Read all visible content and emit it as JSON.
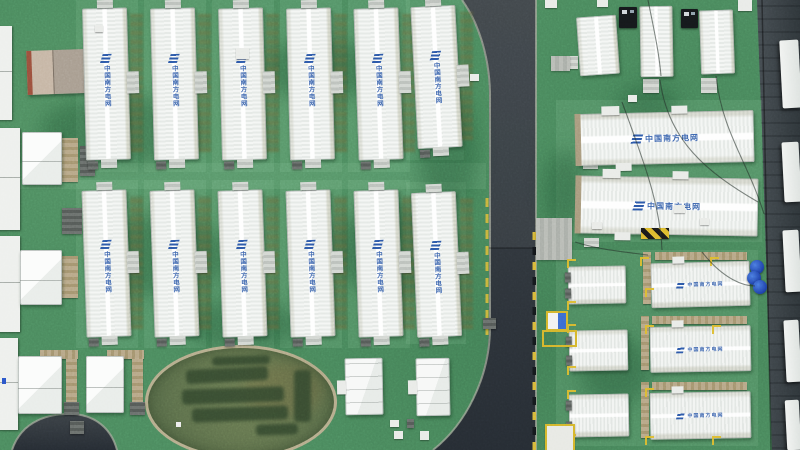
{
  "branding": {
    "label": "中国南方电网",
    "label_color": "#2b57a7"
  },
  "palette": {
    "grass": "#4b8a5e",
    "road_top": "#3b4146",
    "road_bottom": "#262c33",
    "container_white": "#f4f6f4",
    "tray_tan": "#b3a383",
    "wall_dark": "#3a4146",
    "curb_light": "#a6ab9c",
    "dash_yellow": "#d7b83a",
    "dash_black": "#15181c",
    "barrel_blue": "#2a55c8",
    "hedge_green": "#35492f",
    "oval_ring": "#b5ac8c"
  },
  "scene": {
    "patches_light": [
      {
        "x": 76,
        "y": 0,
        "w": 62,
        "h": 172
      },
      {
        "x": 144,
        "y": 0,
        "w": 62,
        "h": 172
      },
      {
        "x": 212,
        "y": 0,
        "w": 62,
        "h": 172
      },
      {
        "x": 280,
        "y": 0,
        "w": 62,
        "h": 172
      },
      {
        "x": 348,
        "y": 0,
        "w": 62,
        "h": 172
      },
      {
        "x": 406,
        "y": 0,
        "w": 58,
        "h": 160
      },
      {
        "x": 76,
        "y": 180,
        "w": 62,
        "h": 168
      },
      {
        "x": 144,
        "y": 180,
        "w": 62,
        "h": 168
      },
      {
        "x": 212,
        "y": 180,
        "w": 62,
        "h": 168
      },
      {
        "x": 280,
        "y": 180,
        "w": 62,
        "h": 168
      },
      {
        "x": 348,
        "y": 180,
        "w": 62,
        "h": 168
      },
      {
        "x": 406,
        "y": 182,
        "w": 60,
        "h": 162
      },
      {
        "x": 0,
        "y": 163,
        "w": 486,
        "h": 26
      },
      {
        "x": 556,
        "y": 100,
        "w": 206,
        "h": 142
      },
      {
        "x": 556,
        "y": 250,
        "w": 202,
        "h": 196
      }
    ],
    "patches_dark": [
      {
        "x": 40,
        "y": 95,
        "w": 160,
        "h": 70
      },
      {
        "x": 260,
        "y": 40,
        "w": 120,
        "h": 60
      },
      {
        "x": 90,
        "y": 215,
        "w": 140,
        "h": 80
      },
      {
        "x": 330,
        "y": 205,
        "w": 130,
        "h": 90
      },
      {
        "x": 418,
        "y": 90,
        "w": 60,
        "h": 120
      },
      {
        "x": 580,
        "y": 335,
        "w": 70,
        "h": 70
      },
      {
        "x": 618,
        "y": 85,
        "w": 60,
        "h": 40
      },
      {
        "x": 180,
        "y": 300,
        "w": 120,
        "h": 50
      },
      {
        "x": 545,
        "y": 150,
        "w": 40,
        "h": 80
      }
    ],
    "containers_v": [
      {
        "x": 84,
        "y": 8,
        "w": 45,
        "h": 152,
        "r": -1.5,
        "lt": 30
      },
      {
        "x": 152,
        "y": 8,
        "w": 45,
        "h": 152,
        "r": -1.5,
        "lt": 30
      },
      {
        "x": 220,
        "y": 8,
        "w": 45,
        "h": 152,
        "r": -1.5,
        "lt": 30
      },
      {
        "x": 288,
        "y": 8,
        "w": 45,
        "h": 152,
        "r": -1.5,
        "lt": 30
      },
      {
        "x": 356,
        "y": 8,
        "w": 45,
        "h": 152,
        "r": -2,
        "lt": 30
      },
      {
        "x": 414,
        "y": 6,
        "w": 45,
        "h": 142,
        "r": -3,
        "lt": 32
      },
      {
        "x": 84,
        "y": 190,
        "w": 45,
        "h": 147,
        "r": -2,
        "lt": 34
      },
      {
        "x": 152,
        "y": 190,
        "w": 45,
        "h": 147,
        "r": -2,
        "lt": 34
      },
      {
        "x": 220,
        "y": 190,
        "w": 45,
        "h": 147,
        "r": -2,
        "lt": 34
      },
      {
        "x": 288,
        "y": 190,
        "w": 45,
        "h": 147,
        "r": -2,
        "lt": 34
      },
      {
        "x": 356,
        "y": 190,
        "w": 45,
        "h": 147,
        "r": -2,
        "lt": 34
      },
      {
        "x": 414,
        "y": 192,
        "w": 45,
        "h": 145,
        "r": -2.5,
        "lt": 34
      }
    ],
    "units_tr": [
      {
        "x": 578,
        "y": 16,
        "w": 40,
        "h": 59,
        "r": -4
      },
      {
        "x": 640,
        "y": 6,
        "w": 33,
        "h": 71,
        "r": -1
      },
      {
        "x": 700,
        "y": 10,
        "w": 34,
        "h": 64,
        "r": -2
      }
    ],
    "containers_h": [
      {
        "x": 577,
        "y": 112,
        "w": 177,
        "h": 52,
        "r": -1.3
      },
      {
        "x": 577,
        "y": 177,
        "w": 181,
        "h": 58,
        "r": 1
      }
    ],
    "big_br": [
      {
        "x": 651,
        "y": 262,
        "w": 99,
        "h": 45,
        "r": -1.5
      },
      {
        "x": 650,
        "y": 326,
        "w": 101,
        "h": 46,
        "r": -1
      },
      {
        "x": 650,
        "y": 392,
        "w": 101,
        "h": 47,
        "r": -1
      }
    ],
    "cubes_br": [
      {
        "x": 568,
        "y": 266,
        "w": 58,
        "h": 38,
        "r": -1
      },
      {
        "x": 569,
        "y": 330,
        "w": 59,
        "h": 41,
        "r": -1
      },
      {
        "x": 569,
        "y": 394,
        "w": 60,
        "h": 43,
        "r": -1
      }
    ],
    "cubes_left": [
      {
        "x": 22,
        "y": 132,
        "w": 40,
        "h": 53
      },
      {
        "x": 20,
        "y": 250,
        "w": 42,
        "h": 55
      },
      {
        "x": 18,
        "y": 356,
        "w": 44,
        "h": 58
      },
      {
        "x": 86,
        "y": 356,
        "w": 38,
        "h": 57
      }
    ],
    "buildings": [
      {
        "x": 345,
        "y": 358,
        "w": 38,
        "h": 57
      },
      {
        "x": 416,
        "y": 358,
        "w": 34,
        "h": 58
      }
    ],
    "strips_left": [
      {
        "x": -10,
        "y": 26,
        "w": 22,
        "h": 94
      },
      {
        "x": -12,
        "y": 128,
        "w": 32,
        "h": 102
      },
      {
        "x": -12,
        "y": 236,
        "w": 32,
        "h": 96
      },
      {
        "x": -12,
        "y": 338,
        "w": 30,
        "h": 92
      }
    ],
    "panels_right": [
      {
        "x": 781,
        "y": 40,
        "w": 19,
        "h": 68
      },
      {
        "x": 783,
        "y": 142,
        "w": 17,
        "h": 60
      },
      {
        "x": 784,
        "y": 230,
        "w": 16,
        "h": 62
      },
      {
        "x": 785,
        "y": 320,
        "w": 15,
        "h": 62
      },
      {
        "x": 786,
        "y": 400,
        "w": 14,
        "h": 50
      }
    ],
    "black_boxes": [
      {
        "x": 619,
        "y": 7,
        "w": 18,
        "h": 21
      },
      {
        "x": 681,
        "y": 9,
        "w": 17,
        "h": 19
      }
    ],
    "barrels": [
      {
        "x": 750,
        "y": 260,
        "d": 14
      },
      {
        "x": 747,
        "y": 271,
        "d": 14
      },
      {
        "x": 753,
        "y": 280,
        "d": 14
      }
    ],
    "trays_h": [
      {
        "x": 655,
        "y": 252,
        "w": 92,
        "h": 8
      },
      {
        "x": 652,
        "y": 316,
        "w": 95,
        "h": 8
      },
      {
        "x": 652,
        "y": 382,
        "w": 95,
        "h": 8
      },
      {
        "x": 40,
        "y": 350,
        "w": 38,
        "h": 9
      },
      {
        "x": 107,
        "y": 350,
        "w": 37,
        "h": 9
      }
    ],
    "trays_v": [
      {
        "x": 643,
        "y": 252,
        "w": 8,
        "h": 52
      },
      {
        "x": 641,
        "y": 316,
        "w": 8,
        "h": 54
      },
      {
        "x": 641,
        "y": 382,
        "w": 8,
        "h": 56
      },
      {
        "x": 66,
        "y": 359,
        "w": 11,
        "h": 45
      },
      {
        "x": 132,
        "y": 359,
        "w": 11,
        "h": 45
      },
      {
        "x": 62,
        "y": 138,
        "w": 16,
        "h": 44
      },
      {
        "x": 62,
        "y": 256,
        "w": 16,
        "h": 42
      }
    ],
    "dark_boxes": [
      {
        "x": 64,
        "y": 402,
        "w": 15,
        "h": 13
      },
      {
        "x": 130,
        "y": 402,
        "w": 15,
        "h": 13
      },
      {
        "x": 80,
        "y": 146,
        "w": 15,
        "h": 30
      },
      {
        "x": 62,
        "y": 208,
        "w": 20,
        "h": 26
      },
      {
        "x": 70,
        "y": 421,
        "w": 14,
        "h": 13
      },
      {
        "x": 483,
        "y": 318,
        "w": 13,
        "h": 11
      },
      {
        "x": 407,
        "y": 419,
        "w": 7,
        "h": 9
      }
    ],
    "steps": [
      {
        "x": 643,
        "y": 79,
        "w": 16,
        "h": 14
      },
      {
        "x": 701,
        "y": 78,
        "w": 16,
        "h": 15
      },
      {
        "x": 563,
        "y": 56,
        "w": 15,
        "h": 13
      },
      {
        "x": 583,
        "y": 160,
        "w": 15,
        "h": 9
      },
      {
        "x": 584,
        "y": 238,
        "w": 15,
        "h": 9
      }
    ],
    "pads": [
      {
        "x": 536,
        "y": 218,
        "w": 36,
        "h": 42
      },
      {
        "x": 551,
        "y": 56,
        "w": 19,
        "h": 15
      }
    ],
    "white_pads": [
      {
        "x": 545,
        "y": 0,
        "w": 12,
        "h": 8
      },
      {
        "x": 597,
        "y": 0,
        "w": 11,
        "h": 7
      },
      {
        "x": 738,
        "y": 0,
        "w": 14,
        "h": 11
      },
      {
        "x": 628,
        "y": 95,
        "w": 9,
        "h": 7
      },
      {
        "x": 674,
        "y": 205,
        "w": 11,
        "h": 8
      },
      {
        "x": 592,
        "y": 222,
        "w": 10,
        "h": 7
      },
      {
        "x": 390,
        "y": 420,
        "w": 9,
        "h": 7
      },
      {
        "x": 394,
        "y": 431,
        "w": 9,
        "h": 8
      },
      {
        "x": 420,
        "y": 431,
        "w": 9,
        "h": 9
      },
      {
        "x": 236,
        "y": 48,
        "w": 13,
        "h": 11
      },
      {
        "x": 700,
        "y": 218,
        "w": 9,
        "h": 7
      },
      {
        "x": 95,
        "y": 25,
        "w": 8,
        "h": 7
      },
      {
        "x": 470,
        "y": 74,
        "w": 9,
        "h": 7
      }
    ],
    "yellow_marks": [
      {
        "x": 567,
        "y": 259
      },
      {
        "x": 640,
        "y": 257
      },
      {
        "x": 710,
        "y": 257
      },
      {
        "x": 567,
        "y": 301
      },
      {
        "x": 645,
        "y": 288
      },
      {
        "x": 567,
        "y": 324
      },
      {
        "x": 645,
        "y": 325
      },
      {
        "x": 712,
        "y": 325
      },
      {
        "x": 567,
        "y": 366
      },
      {
        "x": 645,
        "y": 388
      },
      {
        "x": 567,
        "y": 390
      },
      {
        "x": 645,
        "y": 436
      },
      {
        "x": 567,
        "y": 434
      },
      {
        "x": 712,
        "y": 436
      }
    ],
    "tan_building": {
      "x": 27,
      "y": 50,
      "w": 58,
      "h": 44,
      "r": -2
    },
    "oval": {
      "x": 145,
      "y": 345,
      "w": 186,
      "h": 108,
      "hedges": [
        {
          "x": 38,
          "y": 20,
          "w": 82,
          "h": 14,
          "r": -3
        },
        {
          "x": 34,
          "y": 40,
          "w": 102,
          "h": 15,
          "r": -2
        },
        {
          "x": 44,
          "y": 59,
          "w": 96,
          "h": 14,
          "r": -2
        },
        {
          "x": 146,
          "y": 22,
          "w": 17,
          "h": 52,
          "r": 0
        },
        {
          "x": 108,
          "y": 76,
          "w": 42,
          "h": 11,
          "r": -2
        },
        {
          "x": 64,
          "y": 8,
          "w": 58,
          "h": 9,
          "r": -2
        }
      ]
    },
    "road": {
      "main": "M462,0 L536,0 L536,450 L433,450 C466,425 488,381 489,330 L489,92 C489,56 477,22 462,0 Z",
      "upper_tint": "M462,0 L536,0 L536,248 L489,248 L489,92 C489,56 477,22 462,0 Z",
      "corner": "M12,450 C22,420 50,413 74,414 C98,416 112,431 117,450 Z",
      "curbs": [
        "M462,0 C478,22 489,55 490,92 L490,330 C489,378 466,424 433,450",
        "M536,0 L536,450",
        "M12,450 C22,420 50,413 74,414 C98,416 112,431 117,450"
      ],
      "seam": "M489,248 L536,248",
      "dash_left": {
        "x": 485.5,
        "y0": 198,
        "y1": 330,
        "step": 16,
        "len": 9
      },
      "dash_right": {
        "x": 532.5,
        "y0": 232,
        "y1": 446,
        "step": 15,
        "len": 8
      }
    },
    "wall": {
      "poly": "M757,0 L800,0 L800,450 L772,450 C770,400 766,250 762,130 C760,80 758,30 757,0 Z",
      "hatch_step": 13
    },
    "wires": [
      "M660,80 C668,140 706,172 758,202",
      "M716,76 C722,132 748,162 764,214",
      "M622,102 C644,162 660,204 662,250",
      "M702,252 C724,280 744,286 755,286",
      "M648,0 C654,30 659,52 661,76",
      "M575,242 C600,250 625,252 648,255"
    ],
    "yellow_items": {
      "outlined_pad": {
        "x": 545,
        "y": 424,
        "w": 26,
        "h": 24
      },
      "blue_box": {
        "x": 546,
        "y": 311,
        "w": 18,
        "h": 16
      },
      "outline_only": {
        "x": 542,
        "y": 330,
        "w": 31,
        "h": 13
      },
      "striped_bar": {
        "x": 641,
        "y": 228,
        "w": 28,
        "h": 11
      }
    }
  }
}
